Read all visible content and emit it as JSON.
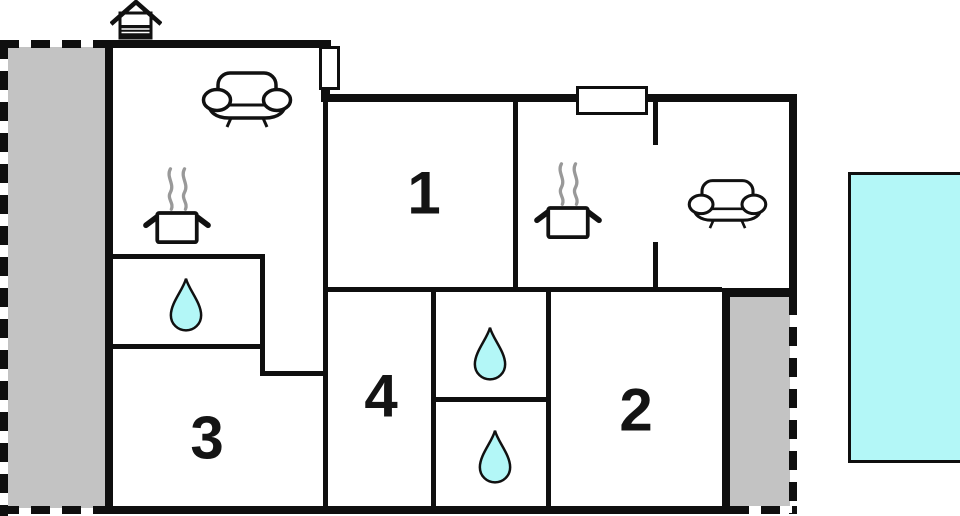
{
  "plan": {
    "title": "Holiday home floor plan",
    "rooms": [
      {
        "id": "room-1",
        "label": "1"
      },
      {
        "id": "room-2",
        "label": "2"
      },
      {
        "id": "room-3",
        "label": "3"
      },
      {
        "id": "room-4",
        "label": "4"
      }
    ],
    "amenities": {
      "sofa_count": 2,
      "stove_count": 2,
      "water_drop_count": 3,
      "fireplace_count": 1,
      "pool_count": 1,
      "terrace_count": 2
    },
    "colors": {
      "wall": "#0f0f0f",
      "terrace_gray": "#c3c3c3",
      "water_cyan": "#b3f7f7",
      "steam_gray": "#999999",
      "background": "#ffffff"
    }
  }
}
